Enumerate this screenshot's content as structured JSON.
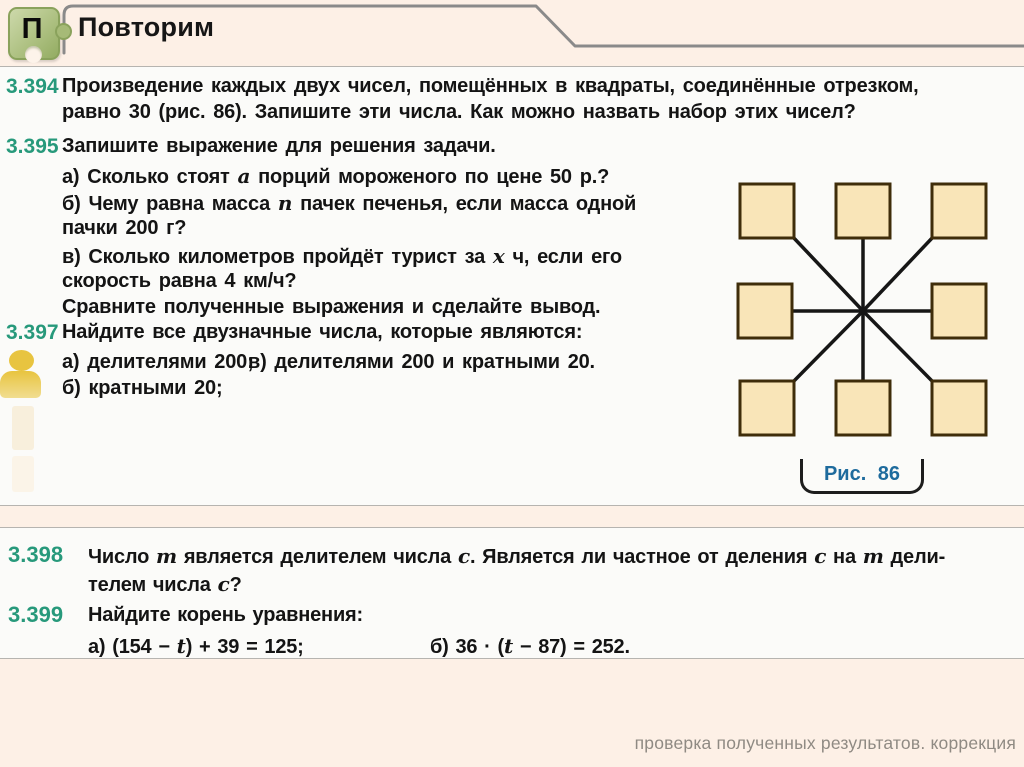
{
  "header": {
    "icon_letter": "П",
    "title": "Повторим"
  },
  "panel1": {
    "p394": {
      "num": "3.394",
      "l1": "Произведение каждых двух чисел, помещённых в квадраты, соединённые отрезком,",
      "l2": "равно 30 (рис. 86). Запишите эти числа. Как можно назвать набор этих чисел?"
    },
    "p395": {
      "num": "3.395",
      "intro": "Запишите выражение для решения задачи.",
      "a_pre": "а) Сколько стоят ",
      "a_var": "a",
      "a_post": " порций мороженого по цене 50 р.?",
      "b_pre": "б) Чему равна масса ",
      "b_var": "n",
      "b_post": " пачек печенья, если масса одной",
      "b_cont": "пачки 200 г?",
      "v_pre": "в) Сколько километров пройдёт турист за ",
      "v_var": "x",
      "v_post": " ч, если его",
      "v_cont": "скорость равна 4 км/ч?",
      "concl": "Сравните полученные выражения и сделайте вывод."
    },
    "p397": {
      "num": "3.397",
      "intro": "Найдите все двузначные числа, которые являются:",
      "item_a": "а) делителями 200;",
      "item_v": "в) делителями 200 и кратными 20.",
      "item_b": "б) кратными 20;"
    }
  },
  "figure": {
    "caption": "Рис. 86",
    "square_count": 8,
    "layout": "eight squares around a center point, each joined to the center by a segment",
    "square_fill": "#f9e5b8",
    "square_border": "#3f2d0a"
  },
  "panel2": {
    "p398": {
      "num": "3.398",
      "l1_parts": [
        "Число ",
        "m",
        " является делителем числа ",
        "c",
        ". Является ли частное от деления ",
        "c",
        " на ",
        "m",
        " дели-"
      ],
      "l2_parts": [
        "телем числа ",
        "c",
        "?"
      ]
    },
    "p399": {
      "num": "3.399",
      "intro": "Найдите корень уравнения:",
      "eq_a_parts": [
        "а) (154 − ",
        "t",
        ") + 39 = 125;"
      ],
      "eq_b_parts": [
        "б) 36 · (",
        "t",
        " − 87) = 252."
      ]
    }
  },
  "footer": {
    "text": "проверка полученных результатов. коррекция"
  },
  "colors": {
    "page_background": "#fdf0e6",
    "panel_background": "#fbfbf9",
    "problem_number_accent": "#27997b",
    "caption_blue": "#1e6b9d",
    "header_line_gray": "#8a8a8a",
    "footer_gray": "#8f8a83",
    "puzzle_green": "#aec182",
    "person_yellow": "#e8c440"
  }
}
